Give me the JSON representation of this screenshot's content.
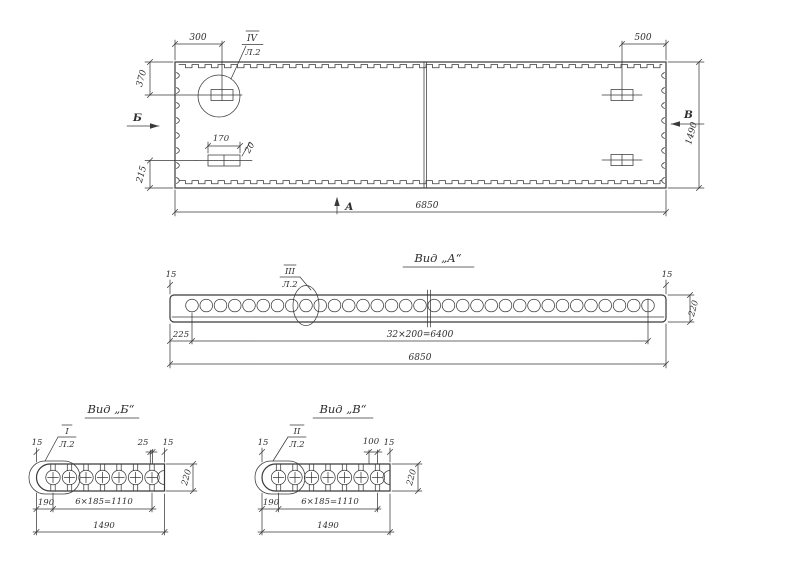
{
  "colors": {
    "background": "#ffffff",
    "ink": "#3a3a3a"
  },
  "plan": {
    "dim_300": "300",
    "dim_500": "500",
    "dim_370": "370",
    "dim_215": "215",
    "dim_1490": "1490",
    "dim_6850": "6850",
    "dim_170": "170",
    "dim_20": "20",
    "callout": {
      "num": "IV",
      "sheet": "Л.2"
    },
    "section_left": "Б",
    "section_right": "В",
    "section_bottom": "А"
  },
  "view_a": {
    "title": "Вид „А“",
    "dim_15_left": "15",
    "dim_15_right": "15",
    "dim_225": "225",
    "dim_holes": "32×200=6400",
    "dim_total": "6850",
    "dim_220": "220",
    "callout": {
      "num": "III",
      "sheet": "Л.2"
    }
  },
  "view_b": {
    "title": "Вид „Б“",
    "dim_15_left": "15",
    "dim_25": "25",
    "dim_15_right": "15",
    "dim_220": "220",
    "dim_190": "190",
    "dim_holes": "6×185=1110",
    "dim_total": "1490",
    "callout": {
      "num": "I",
      "sheet": "Л.2"
    }
  },
  "view_v": {
    "title": "Вид „В“",
    "dim_15_left": "15",
    "dim_100": "100",
    "dim_15_right": "15",
    "dim_220": "220",
    "dim_190": "190",
    "dim_holes": "6×185=1110",
    "dim_total": "1490",
    "callout": {
      "num": "II",
      "sheet": "Л.2"
    }
  }
}
